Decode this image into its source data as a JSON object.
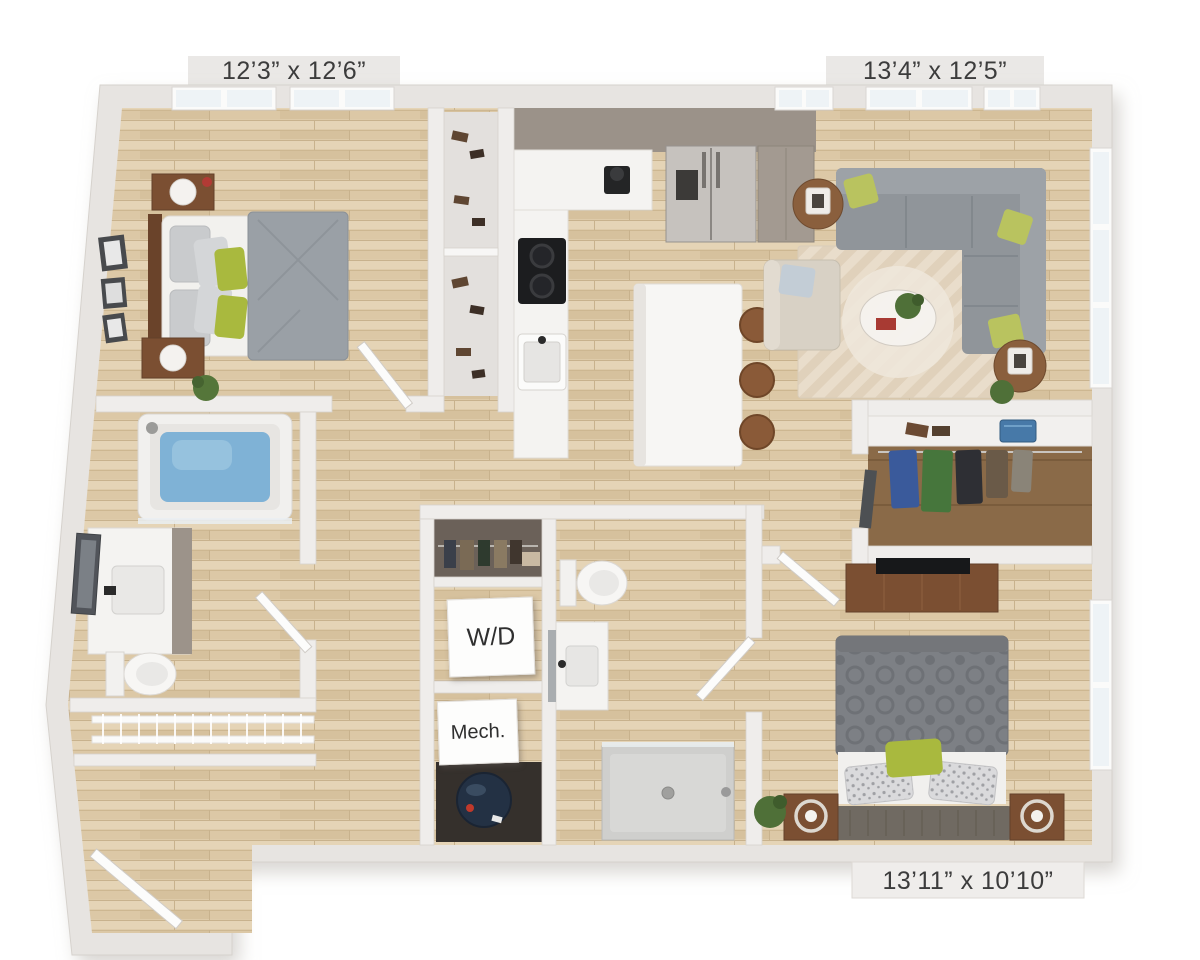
{
  "labels": {
    "bedroom1_dims": "12’3” x 12’6”",
    "living_dims": "13’4” x 12’5”",
    "bedroom2_dims": "13’11” x 10’10”",
    "washer_dryer": "W/D",
    "mechanical": "Mech."
  },
  "palette": {
    "background": "#ffffff",
    "wall": "#e7e4e1",
    "interior_wall": "#efedeb",
    "floor_wood": "#decbaa",
    "closet_wood": "#8a6a48",
    "cabinet_taupe": "#9b9289",
    "counter_white": "#f5f4f2",
    "sofa_gray": "#90959a",
    "accent_green": "#a9b93e",
    "tub_water_blue": "#7fb2d6",
    "rug_beige": "#e9ddcb",
    "wood_furniture": "#7b4f32",
    "water_heater_navy": "#233144",
    "label_text": "#3c3c3c"
  },
  "rooms": {
    "bedroom1": {
      "fixtures": [
        "queen-bed",
        "headboard",
        "nightstands",
        "table-lamps",
        "plant",
        "picture-frames",
        "reach-in-closet",
        "shoe-shelves",
        "windows"
      ]
    },
    "kitchen": {
      "fixtures": [
        "l-shaped-counter",
        "cooktop",
        "sink",
        "coffee-maker",
        "refrigerator",
        "pantry-cabinet",
        "island",
        "bar-stools"
      ]
    },
    "living_room": {
      "fixtures": [
        "sectional-sofa",
        "throw-pillows",
        "area-rug",
        "coffee-table",
        "accent-chair",
        "side-tables",
        "table-lamps",
        "plant",
        "windows"
      ]
    },
    "bathroom1": {
      "fixtures": [
        "bathtub",
        "shower-head",
        "vanity-sink",
        "leaning-mirror",
        "toilet",
        "linen-shelves"
      ]
    },
    "hall_utility": {
      "fixtures": [
        "coat-closet",
        "washer-dryer",
        "mechanical-closet",
        "water-heater"
      ]
    },
    "bathroom2": {
      "fixtures": [
        "toilet",
        "vanity-sink",
        "mirror",
        "walk-in-shower"
      ]
    },
    "walk_in_closet": {
      "fixtures": [
        "hanging-clothes",
        "shelf",
        "shoes",
        "storage-basket",
        "leaning-mirror"
      ]
    },
    "bedroom2": {
      "fixtures": [
        "queen-bed",
        "patterned-duvet",
        "dresser",
        "tv",
        "nightstands",
        "ring-lamps",
        "plant",
        "window"
      ]
    },
    "entry": {
      "fixtures": [
        "front-door"
      ]
    }
  }
}
